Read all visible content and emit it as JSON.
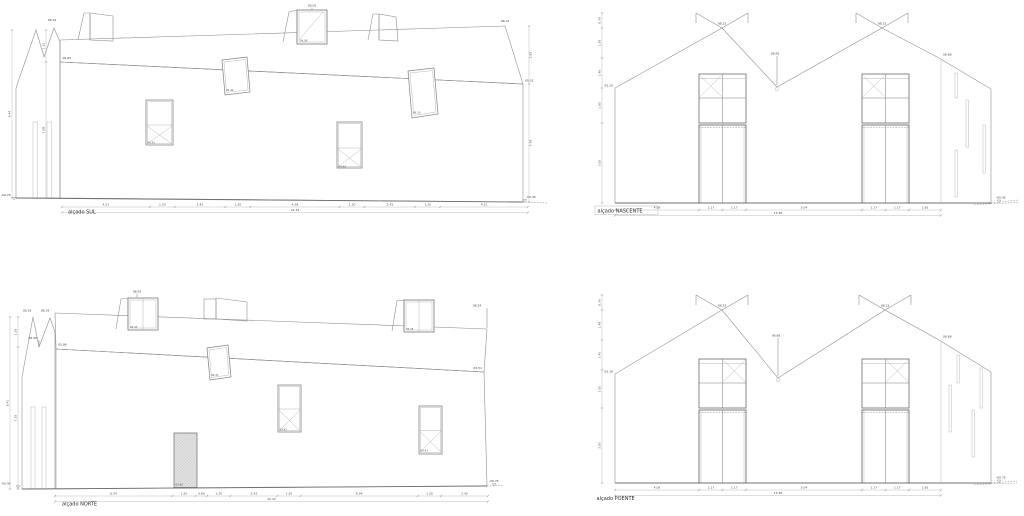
{
  "sheet": {
    "background": "#ffffff"
  },
  "colors": {
    "outline": "#8f8f8f",
    "outline_dark": "#5c5c5c",
    "hatch_roof": "#d8d8d8",
    "hatch_wall": "#c2c2c2",
    "door_fill": "#dedede",
    "dim_line": "#ababab",
    "text": "#4a4a4a"
  },
  "drawings": {
    "sul": {
      "label": "alçado SUL",
      "levels": {
        "peak_left": "08.19",
        "eave_left": "06.84",
        "peak_right": "08.14",
        "eave_right": "05.31",
        "ground_left": "-00.25",
        "ground_right": "-00.45",
        "dormer_top": "08.05",
        "dormer_sill": "06.08",
        "roof_window_1": "06.42",
        "roof_window_2": "06.10",
        "window_1": "04.41",
        "window_2": "04.43"
      },
      "dims_bottom": [
        "4.21",
        "1.20",
        "2.42",
        "1.20",
        "4.28",
        "1.20",
        "2.42",
        "1.20",
        "4.21"
      ],
      "dim_total": "22.34",
      "dims_left": [
        "1.35",
        "7.09"
      ],
      "dim_height_left": "8.44",
      "dims_right": [
        "2.83",
        "5.76"
      ]
    },
    "nascente": {
      "label": "alçado NASCENTE",
      "levels": {
        "peak_1": "08.23",
        "peak_2": "08.23",
        "valley": "06.65",
        "eave_left": "05.20",
        "eave_right": "06.68",
        "ground": "-00.45"
      },
      "dims_bottom": [
        "4.09",
        "1.17",
        "1.17",
        "5.04",
        "1.17",
        "1.17",
        "1.65"
      ],
      "dim_total": "15.46",
      "dims_left": [
        "0.76",
        "1.50",
        "1.40",
        "1.65",
        "3.05"
      ]
    },
    "norte": {
      "label": "alçado NORTE",
      "levels": {
        "peak_left_1": "08.19",
        "peak_left_2": "08.19",
        "valley_left": "06.58",
        "eave_left": "05.98",
        "peak_right": "08.24",
        "eave_right": "05.51",
        "ground_left": "-00.45",
        "ground_right": "-00.75",
        "dormer_1_top": "08.92",
        "dormer_1_sill": "06.45",
        "dormer_2_sill": "05.45",
        "roof_window": "06.43",
        "window_1": "04.43",
        "window_2": "04.41",
        "door": "00.60"
      },
      "dims_bottom": [
        "6.04",
        "1.20",
        "0.60",
        "1.20",
        "2.42",
        "1.20",
        "6.04",
        "1.20",
        "2.42"
      ],
      "dim_total": "22.32",
      "dims_left": [
        "1.36",
        "7.28"
      ],
      "dim_height_left": "8.41"
    },
    "poente": {
      "label": "alçado POENTE",
      "levels": {
        "peak_1": "08.23",
        "peak_2": "08.23",
        "valley": "06.68",
        "eave_left": "05.16",
        "eave_right": "06.68",
        "ground": "-00.75"
      },
      "dims_bottom": [
        "4.09",
        "1.17",
        "1.17",
        "5.04",
        "1.17",
        "1.17",
        "1.65"
      ],
      "dim_total": "15.46",
      "dims_left": [
        "0.76",
        "1.48",
        "1.45",
        "1.65",
        "3.05"
      ]
    }
  }
}
